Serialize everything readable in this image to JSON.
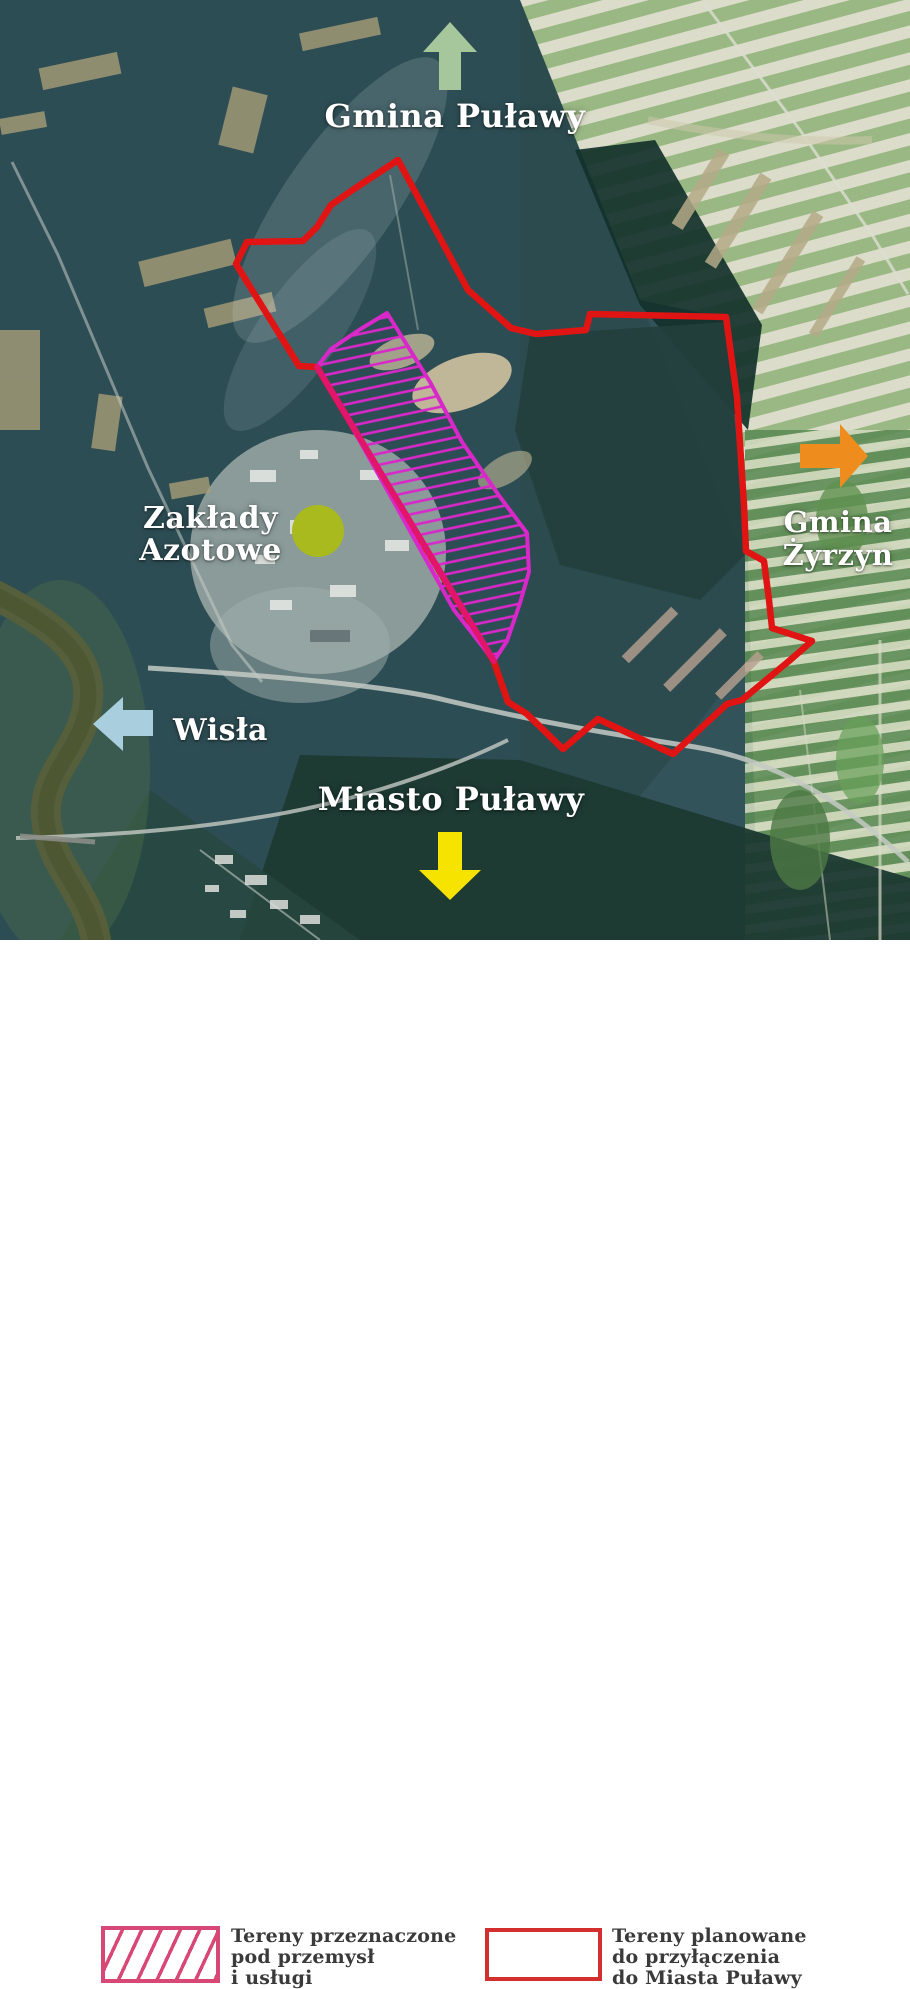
{
  "map": {
    "labels": {
      "gmina_pulawy": "Gmina Puławy",
      "gmina_zyrzyn_line1": "Gmina",
      "gmina_zyrzyn_line2": "Żyrzyn",
      "zaklady_line1": "Zakłady",
      "zaklady_line2": "Azotowe",
      "wisla": "Wisła",
      "miasto_pulawy": "Miasto Puławy"
    },
    "arrows": [
      {
        "direction": "up",
        "points_to": "Gmina Puławy",
        "color": "#a5c79b"
      },
      {
        "direction": "right",
        "points_to": "Gmina Żyrzyn",
        "color": "#ee8c1e"
      },
      {
        "direction": "left",
        "points_to": "Wisła",
        "color": "#a9cede"
      },
      {
        "direction": "down",
        "points_to": "Miasto Puławy",
        "color": "#f6e400"
      }
    ],
    "marker": {
      "shape": "circle",
      "color": "#a9ba1e",
      "marks": "Zakłady Azotowe"
    },
    "overlays": {
      "industrial_area_color": "#d928c9",
      "industrial_area_style": "magenta hatched polygon",
      "annexation_boundary_color": "#e11414",
      "annexation_boundary_style": "red outline polygon",
      "shared_edge_color": "#e0156b"
    }
  },
  "legend": {
    "items": [
      {
        "swatch": "pink-hatched-box",
        "color": "#d84876",
        "lines": [
          "Tereny przeznaczone",
          "pod przemysł",
          "i usługi"
        ]
      },
      {
        "swatch": "red-outline-box",
        "color": "#d42f2f",
        "lines": [
          "Tereny planowane",
          "do przyłączenia",
          "do Miasta Puławy"
        ]
      }
    ]
  }
}
